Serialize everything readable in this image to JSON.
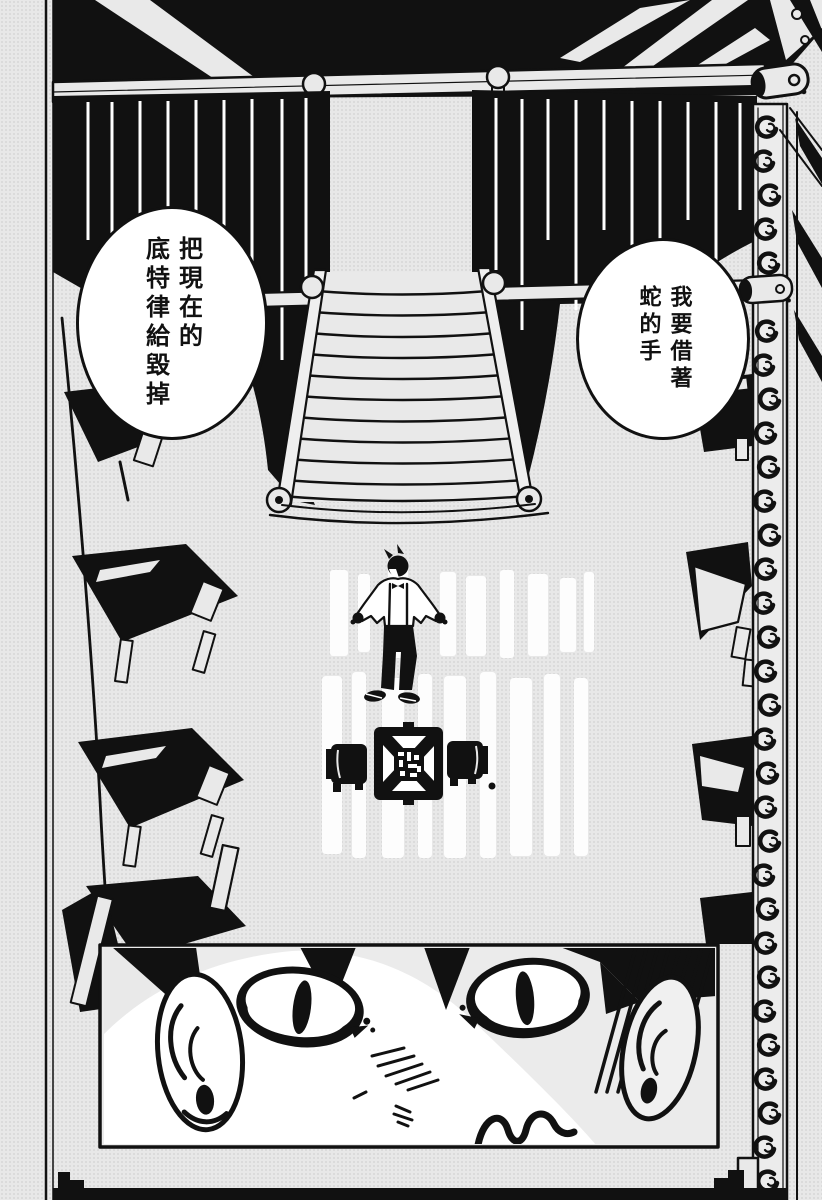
{
  "meta": {
    "page_type": "manga-page",
    "language": "zh-Hant",
    "ink_color": "#111111",
    "paper_color": "#e8e8e8",
    "highlight_color": "#ffffff"
  },
  "panels": [
    {
      "name": "hall-overview-panel",
      "description": "Top-down theater hall: black ceiling rig and curtains, central staircase, lone figure in floor light beams, small ring table with two chairs, spiral column at right",
      "bubbles": [
        {
          "name": "speech-bubble-right",
          "reading_order": 1,
          "columns": [
            "我要借著",
            "蛇的手"
          ],
          "text": "我要借著蛇的手"
        },
        {
          "name": "speech-bubble-left",
          "reading_order": 2,
          "columns": [
            "把現在的",
            "底特律給毀掉"
          ],
          "text": "把現在的底特律給毀掉"
        }
      ]
    },
    {
      "name": "eyes-closeup-panel",
      "description": "Close-up of a staring face: two wide eyes with narrow vertical pupils, ears, hatched shading"
    }
  ]
}
